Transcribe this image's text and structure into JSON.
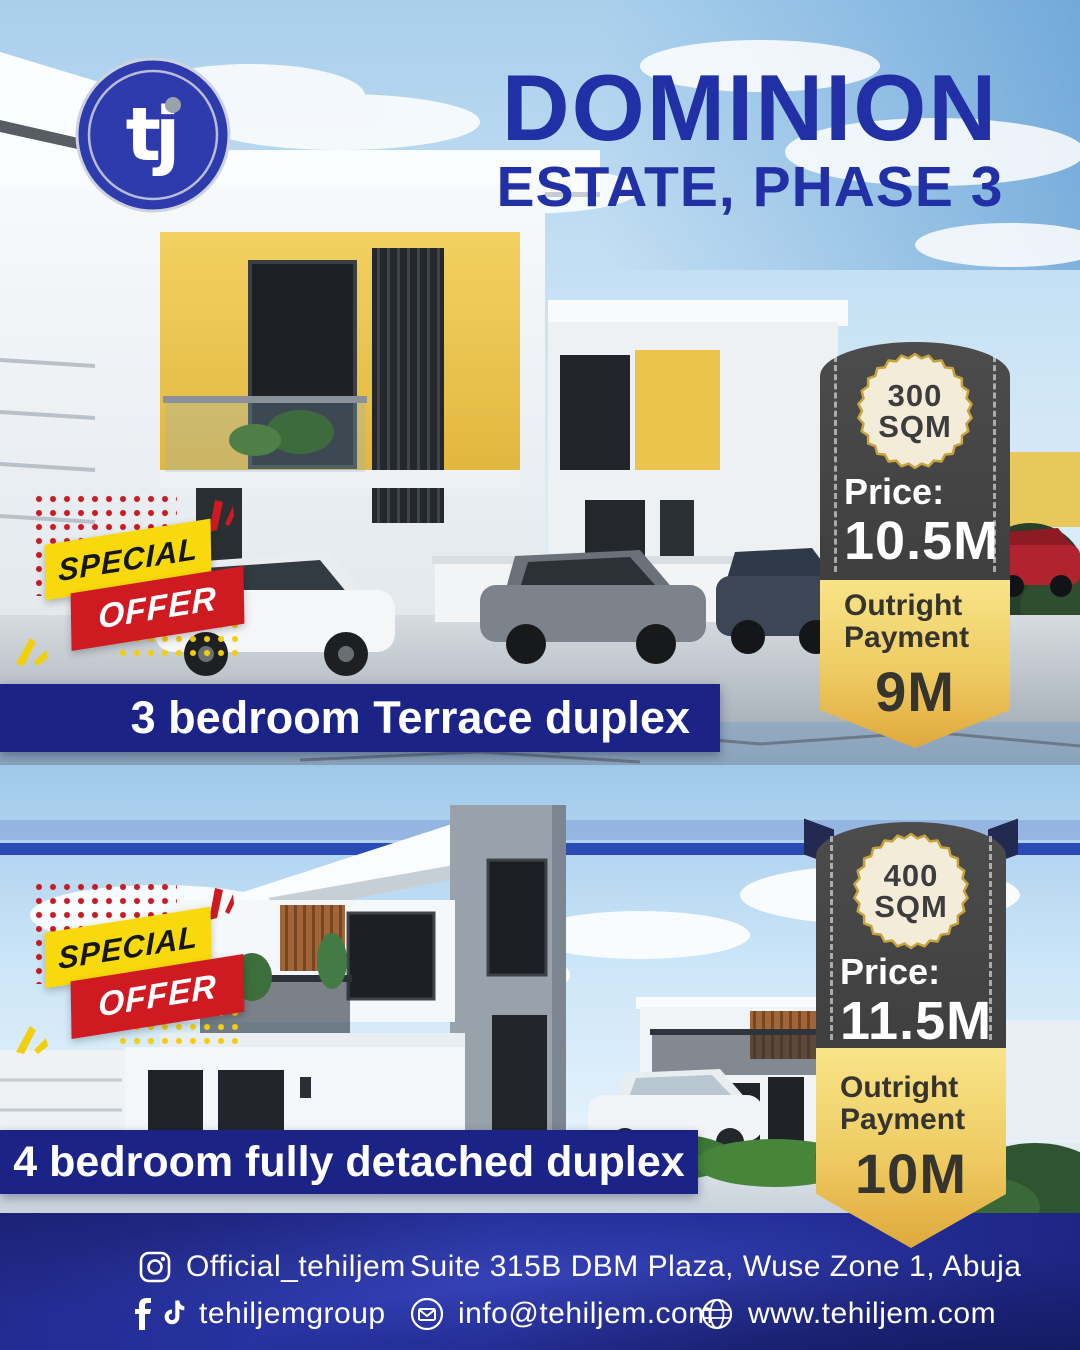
{
  "brand": {
    "logo_text": "tj",
    "title_line1": "DOMINION",
    "title_line2": "ESTATE, PHASE 3"
  },
  "offers": [
    {
      "badge_line1": "SPECIAL",
      "badge_line2": "OFFER",
      "sqm_value": "300",
      "sqm_unit": "SQM",
      "price_label": "Price:",
      "price_value": "10.5M",
      "outright_line1": "Outright",
      "outright_line2": "Payment",
      "outright_value": "9M",
      "banner": "3 bedroom Terrace duplex"
    },
    {
      "badge_line1": "SPECIAL",
      "badge_line2": "OFFER",
      "sqm_value": "400",
      "sqm_unit": "SQM",
      "price_label": "Price:",
      "price_value": "11.5M",
      "outright_line1": "Outright",
      "outright_line2": "Payment",
      "outright_value": "10M",
      "banner": "4 bedroom fully detached duplex"
    }
  ],
  "footer": {
    "instagram_handle": "Official_tehiljem",
    "address": "Suite 315B DBM Plaza, Wuse Zone 1, Abuja",
    "social_handle": "tehiljemgroup",
    "email": "info@tehiljem.com",
    "website": "www.tehiljem.com"
  },
  "icons": {
    "logo": "tj-circle-logo",
    "footer_row1": [
      "instagram-icon"
    ],
    "footer_row2": [
      "facebook-icon",
      "tiktok-icon",
      "email-icon",
      "website-icon"
    ]
  },
  "colors": {
    "title_blue": "#2230a6",
    "banner_blue": "#1b2387",
    "footer_blue": "#2c37ad",
    "ribbon_gray": "#454545",
    "gold": "#eecb62",
    "seal_cream": "#f3ecd9",
    "offer_red": "#cf1a22",
    "offer_yellow": "#f8da0c"
  }
}
